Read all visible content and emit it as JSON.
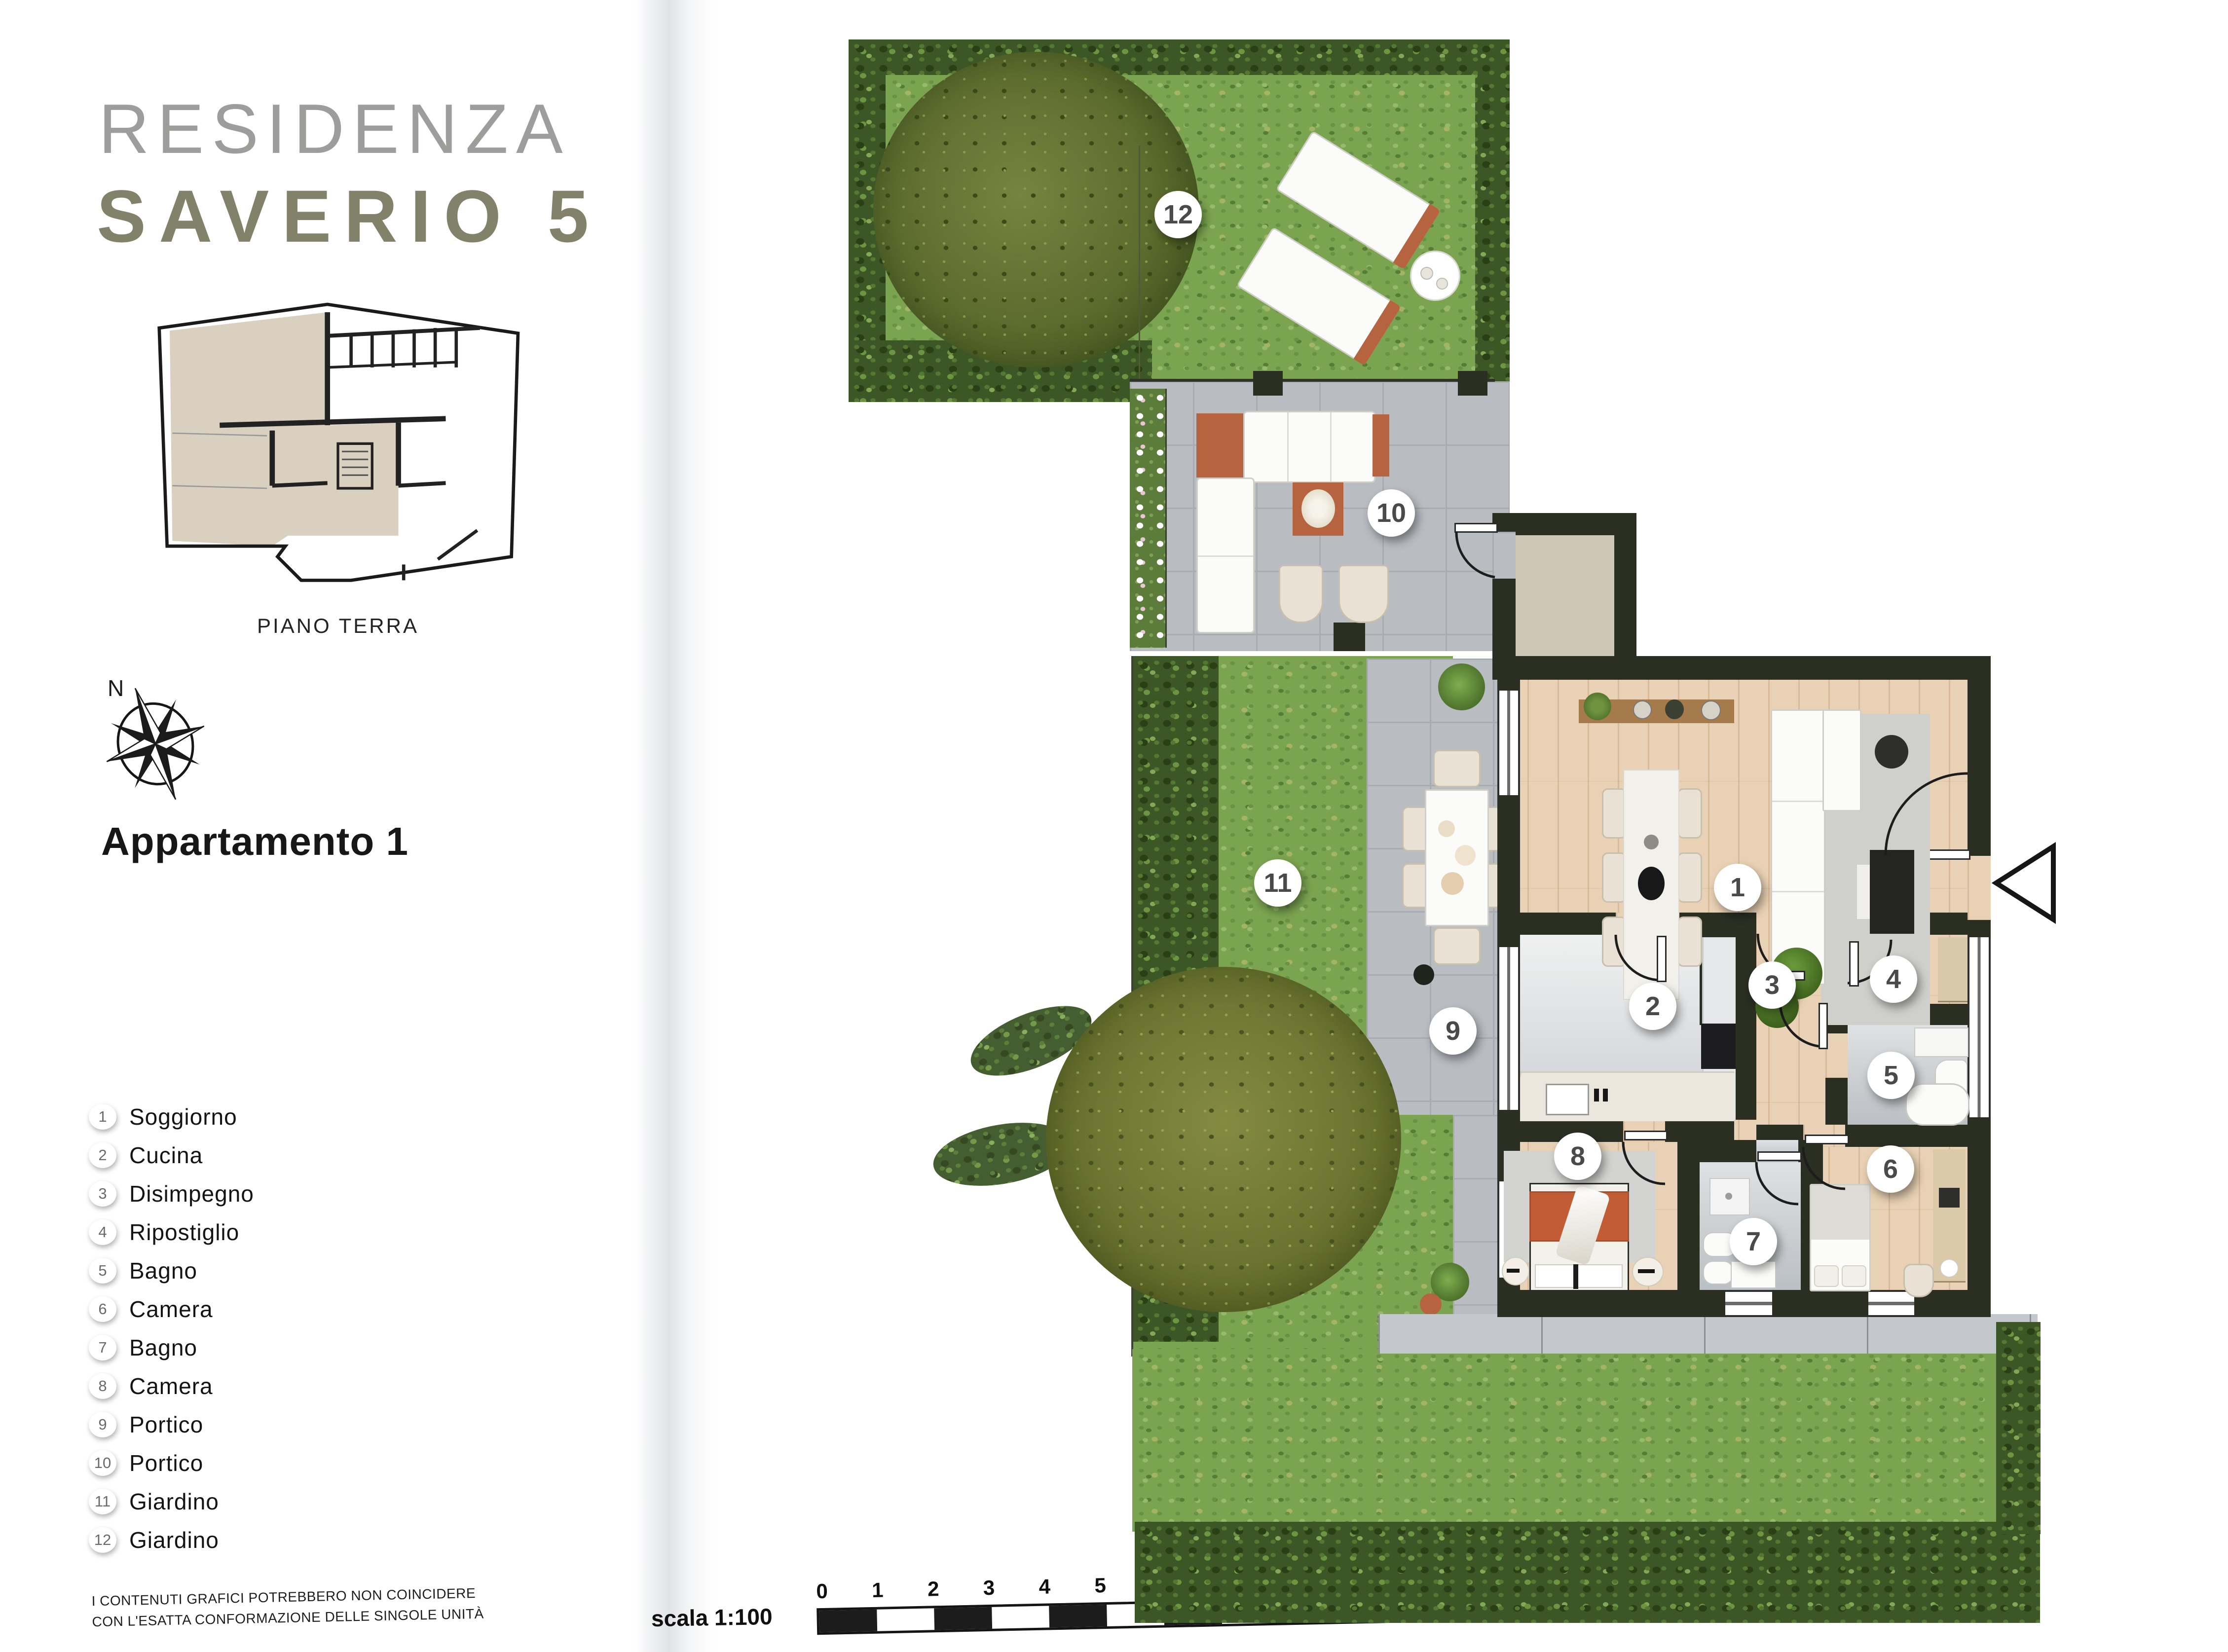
{
  "header": {
    "title_line1": "RESIDENZA",
    "title_line2": "SAVERIO 5"
  },
  "siteplan": {
    "caption": "PIANO TERRA"
  },
  "compass": {
    "north_label": "N"
  },
  "apartment": {
    "title": "Appartamento 1"
  },
  "legend": {
    "items": [
      {
        "num": "1",
        "label": "Soggiorno"
      },
      {
        "num": "2",
        "label": "Cucina"
      },
      {
        "num": "3",
        "label": "Disimpegno"
      },
      {
        "num": "4",
        "label": "Ripostiglio"
      },
      {
        "num": "5",
        "label": "Bagno"
      },
      {
        "num": "6",
        "label": "Camera"
      },
      {
        "num": "7",
        "label": "Bagno"
      },
      {
        "num": "8",
        "label": "Camera"
      },
      {
        "num": "9",
        "label": "Portico"
      },
      {
        "num": "10",
        "label": "Portico"
      },
      {
        "num": "11",
        "label": "Giardino"
      },
      {
        "num": "12",
        "label": "Giardino"
      }
    ]
  },
  "footer": {
    "disclaimer_line1": "I CONTENUTI GRAFICI POTREBBERO NON COINCIDERE",
    "disclaimer_line2": "CON L'ESATTA CONFORMAZIONE DELLE SINGOLE UNITÀ",
    "scale_label": "scala 1:100",
    "scale_ticks": [
      "0",
      "1",
      "2",
      "3",
      "4",
      "5",
      "6",
      "7",
      "8",
      "9",
      "10"
    ]
  },
  "icons": {
    "compass": "compass-rose-icon",
    "entrance_arrow": "entrance-arrow-icon"
  },
  "colors": {
    "wall": "#2a2f22",
    "grass": "#7ba450",
    "hedge": "#3c5626",
    "paving": "#b9bdc2",
    "wood_floor": "#e8d1b4",
    "terracotta": "#b5643f",
    "title_gray": "#9d9d9b",
    "title_olive": "#82826b",
    "badge_text": "#4a4a4a"
  }
}
